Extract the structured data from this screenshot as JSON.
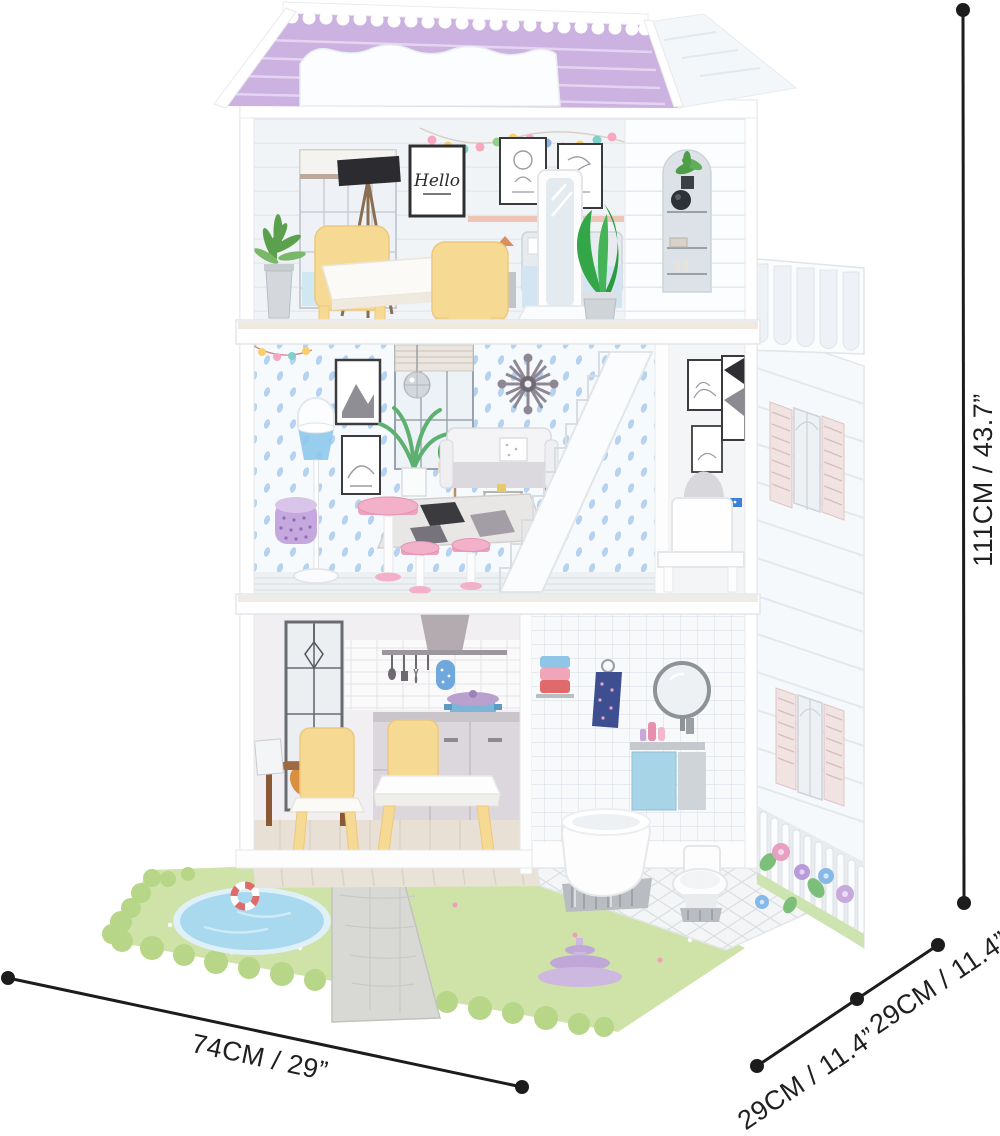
{
  "canvas": {
    "width": 1000,
    "height": 1136,
    "background": "#ffffff"
  },
  "dimension_annotations": {
    "width_label": "74CM / 29”",
    "height_label": "111CM / 43.7”",
    "depth_label_front": "29CM / 11.4”",
    "depth_label_side": "29CM / 11.4”"
  },
  "dollhouse": {
    "hello_sign": "Hello",
    "colors": {
      "roof_purple": "#cbb2e0",
      "wall_white": "#fdfdfe",
      "wall_light": "#f1f4f7",
      "wallpaper_dot_blue": "#aecdf0",
      "furniture_yellow": "#f6d992",
      "furniture_pink": "#f3b0c9",
      "lamp_blue": "#8cc6ec",
      "pouf_purple": "#c5a8de",
      "garden_green": "#cfe3a9",
      "pool_blue": "#a8d9ef",
      "path_gray": "#d8d9d5",
      "dimension_black": "#1c1c1c"
    }
  }
}
